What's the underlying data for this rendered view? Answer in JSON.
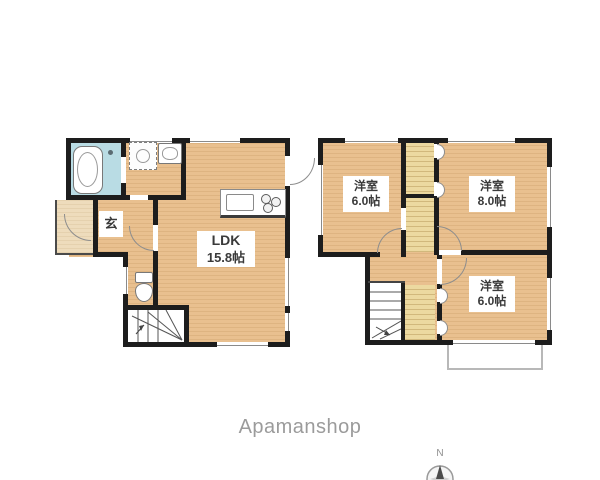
{
  "page": {
    "brand": "Apamanshop",
    "background": "#ffffff"
  },
  "compass": {
    "label": "N"
  },
  "floor1": {
    "entrance_label": "玄",
    "ldk": {
      "name": "LDK",
      "size": "15.8帖"
    },
    "fixtures": [
      "bathtub",
      "washing-machine",
      "vanity-sink",
      "kitchen-counter",
      "toilet",
      "staircase"
    ]
  },
  "floor2": {
    "room_nw": {
      "name": "洋室",
      "size": "6.0帖"
    },
    "room_ne": {
      "name": "洋室",
      "size": "8.0帖"
    },
    "room_se": {
      "name": "洋室",
      "size": "6.0帖"
    },
    "features": [
      "closet",
      "staircase",
      "balcony"
    ]
  },
  "colors": {
    "wall": "#1d1d1d",
    "floor_wood": "#e9c08f",
    "bathroom": "#b9dce4",
    "porch": "#eedcbc",
    "closet": "#ecd9a0",
    "balcony_border": "#b8b8b8",
    "brand_text": "#9b9b9b"
  }
}
